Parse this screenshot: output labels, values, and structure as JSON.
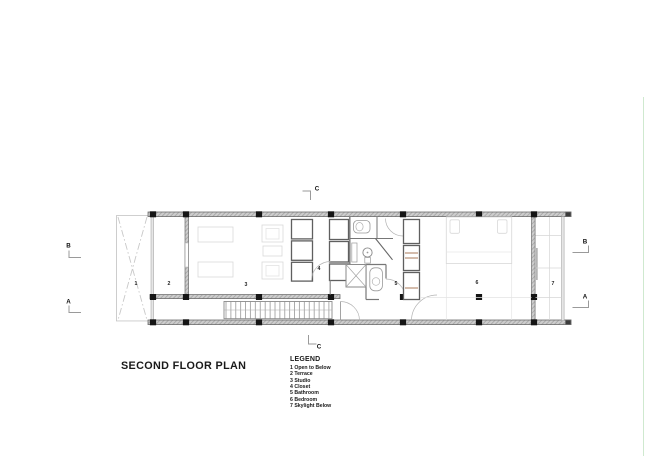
{
  "title": "SECOND FLOOR PLAN",
  "legend": {
    "title": "LEGEND",
    "items": [
      "1 Open to Below",
      "2 Terrace",
      "3 Studio",
      "4 Closet",
      "5 Bathroom",
      "6 Bedroom",
      "7 Skylight Below"
    ]
  },
  "plan": {
    "room_labels": [
      {
        "number": "1",
        "x": 136,
        "y": 284
      },
      {
        "number": "2",
        "x": 169,
        "y": 284
      },
      {
        "number": "3",
        "x": 246,
        "y": 285
      },
      {
        "number": "4",
        "x": 319,
        "y": 269
      },
      {
        "number": "5",
        "x": 396,
        "y": 284
      },
      {
        "number": "6",
        "x": 477,
        "y": 283
      },
      {
        "number": "7",
        "x": 553,
        "y": 284
      }
    ],
    "section_markers": [
      {
        "label": "B",
        "x": 68.5,
        "y": 246
      },
      {
        "label": "A",
        "x": 68.5,
        "y": 301.5
      },
      {
        "label": "C",
        "x": 317,
        "y": 188.5
      },
      {
        "label": "C",
        "x": 319,
        "y": 346.5
      },
      {
        "label": "B",
        "x": 585,
        "y": 241.5
      },
      {
        "label": "A",
        "x": 585,
        "y": 296.5
      }
    ],
    "colors": {
      "wall_fill": "#cdcdcd",
      "wall_edge": "#6f6f6f",
      "column": "#151515",
      "thin_line": "#8a8a8a",
      "furniture_line": "#d9d9d9",
      "wood_accent": "#a9795a",
      "page_edge_green": "#cfe9cf"
    }
  }
}
